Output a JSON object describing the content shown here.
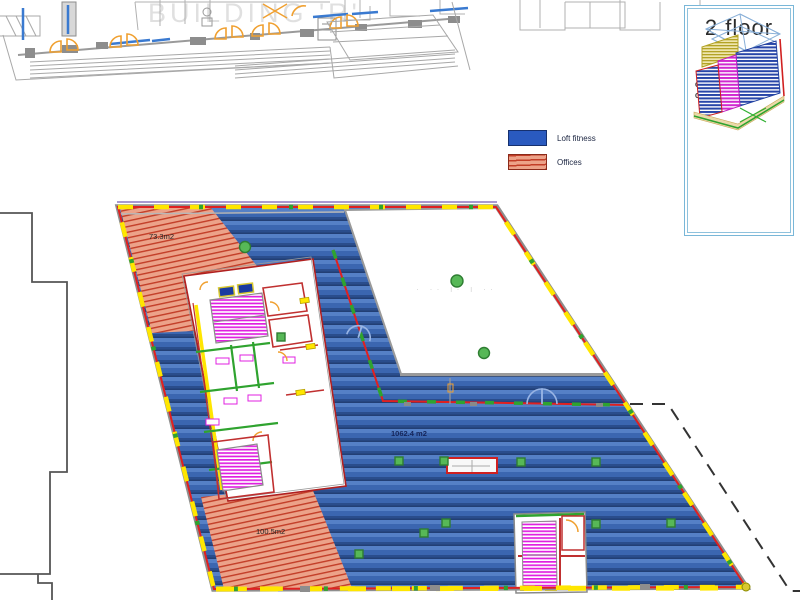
{
  "background_plan": {
    "watermark": "BUILDING 'R'"
  },
  "legend": {
    "items": [
      {
        "label": "Loft fitness",
        "color": "#2a5abf"
      },
      {
        "label": "Offices",
        "color": "#eca289"
      }
    ]
  },
  "title_block": {
    "floor_label": "2 floor",
    "gba_label": "GBA- 1587.1 m2",
    "gla_label": "GLA- 1064.2m2"
  },
  "plan_labels": {
    "offices_upper_area": "73.3m2",
    "loft_fitness_area": "1062.4 m2",
    "offices_lower_area": "100.5m2",
    "faint_note": "· ·· ı· ı ··"
  },
  "colors": {
    "loft_fitness_base": "#3b66b0",
    "loft_fitness_light": "#5580c6",
    "loft_fitness_dark": "#27497f",
    "offices_base": "#eca289",
    "offices_line": "#c23d27",
    "perimeter_red": "#e02020",
    "window_yellow": "#ffe600",
    "wall_green": "#2fa32f",
    "stair_magenta": "#e020e0",
    "door_orange": "#f0a030",
    "panel_border": "#79b7d8",
    "dashed_boundary": "#333333",
    "neighbor_outline": "#555555",
    "background_gray": "#b5b5b5"
  }
}
